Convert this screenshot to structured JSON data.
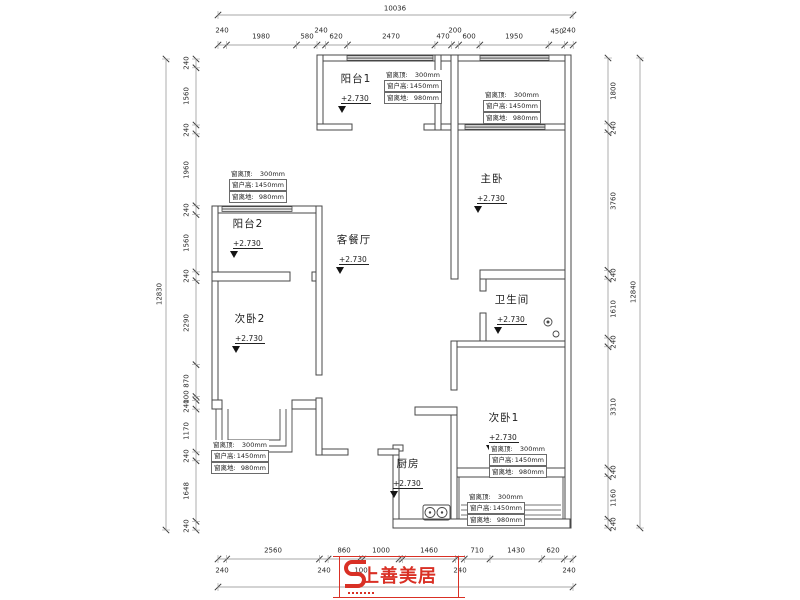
{
  "dims": {
    "top_total": "10036",
    "top": [
      "240",
      "1980",
      "580",
      "240",
      "620",
      "2470",
      "470",
      "200",
      "600",
      "1950",
      "450",
      "240"
    ],
    "left_total": "12830",
    "left": [
      "240",
      "1560",
      "240",
      "1960",
      "240",
      "1560",
      "240",
      "2290",
      "870",
      "100",
      "240",
      "1170",
      "240",
      "1648",
      "240"
    ],
    "right_total": "12840",
    "right": [
      "1800",
      "240",
      "3760",
      "240",
      "1610",
      "240",
      "3310",
      "240",
      "1160",
      "240"
    ],
    "bottom_main": [
      "2560",
      "860",
      "1000",
      "1460",
      "710",
      "1430",
      "620"
    ],
    "bottom_small": [
      "240",
      "240",
      "100",
      "240",
      "240"
    ]
  },
  "rooms": {
    "balcony1": {
      "name": "阳台1",
      "level": "+2.730"
    },
    "balcony2": {
      "name": "阳台2",
      "level": "+2.730"
    },
    "living": {
      "name": "客餐厅",
      "level": "+2.730"
    },
    "master": {
      "name": "主卧",
      "level": "+2.730"
    },
    "bath": {
      "name": "卫生间",
      "level": "+2.730"
    },
    "bed1": {
      "name": "次卧1",
      "level": "+2.730"
    },
    "bed2": {
      "name": "次卧2",
      "level": "+2.730"
    },
    "kitchen": {
      "name": "厨房",
      "level": "+2.730"
    }
  },
  "window_note": {
    "rows": [
      {
        "label": "窗离顶:",
        "value": "300mm"
      },
      {
        "label": "窗户高:",
        "value": "1450mm"
      },
      {
        "label": "窗离地:",
        "value": "980mm"
      }
    ]
  },
  "logo": {
    "text": "上善美居"
  },
  "colors": {
    "wall": "#474747",
    "dim_line": "#8a8a8a",
    "brand_red": "#d93025"
  }
}
